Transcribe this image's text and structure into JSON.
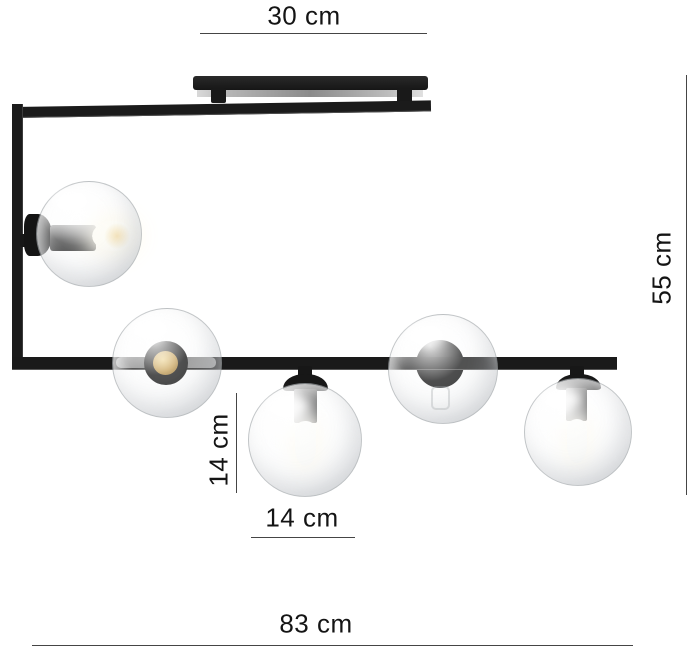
{
  "product": {
    "globe_count": "5",
    "frame_color": "#1c1c1c",
    "glass_edge_color": "#aeb2b5",
    "brass_socket_color": "#c69f55",
    "bulb_glow_color": "#fffdf2",
    "background_color": "#ffffff"
  },
  "dimensions": {
    "canopy_width": "30 cm",
    "fixture_height": "55 cm",
    "globe_diameter_vertical": "14 cm",
    "globe_diameter_horizontal": "14 cm",
    "fixture_width": "83 cm"
  }
}
